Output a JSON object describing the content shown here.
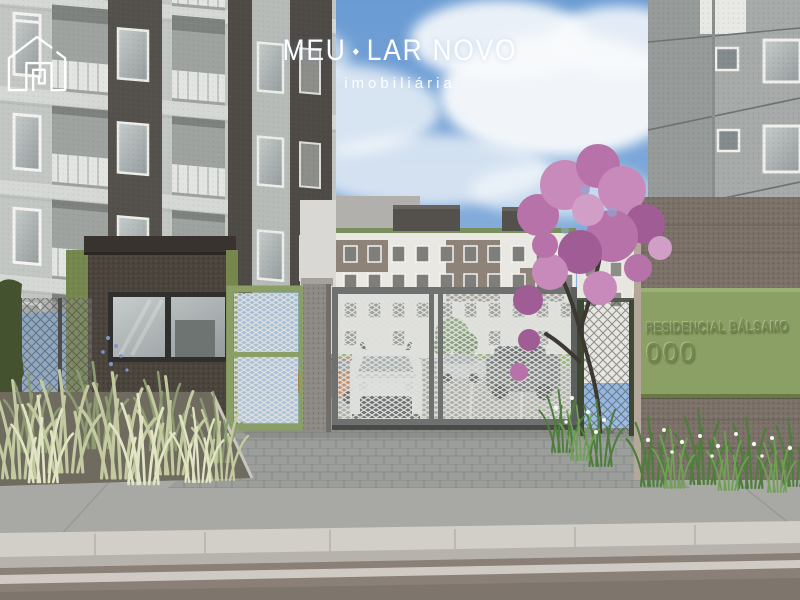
{
  "brand": {
    "icon": "house-outline-icon",
    "title_word1": "MEU",
    "title_separator": "◆",
    "title_word2": "LAR NOVO",
    "subtitle": "imobiliária"
  },
  "sign": {
    "line1": "RESIDENCIAL BÁLSAMO",
    "line2": "000"
  },
  "colors": {
    "sky_top": "#6a9bd3",
    "sky_bottom": "#b8cfe9",
    "cloud_white": "#f8fafc",
    "brand_text": "#ffffff",
    "sign_panel_green": "#8ba064",
    "sign_text_green": "#74874d",
    "accent_green": "#8a9e66",
    "dark_green_post": "#3d4733",
    "guardhouse_brown": "#4b443d",
    "masonry_brown": "#7b7168",
    "building_light_gray": "#c3c7c4",
    "building_dark_gray": "#4e4a45",
    "background_building_white": "#e9e8e3",
    "taupe_panel": "#8e8379",
    "right_building_gray": "#9da1a0",
    "gate_mesh_gray": "#ced0cc",
    "gate_frame_gray": "#6f7170",
    "sidewalk_gray": "#a8a9a5",
    "asphalt_brown": "#8a8078",
    "curb_concrete": "#d2cfc8",
    "road_line_white": "#d6d3cc",
    "pink_tree": "#b66fa8",
    "grass_pale": "#c3caa0",
    "grass_green": "#5d8a45",
    "car_white": "#e3e4e2",
    "car_orange": "#c2673a",
    "car_dark_gray": "#4d5052"
  }
}
